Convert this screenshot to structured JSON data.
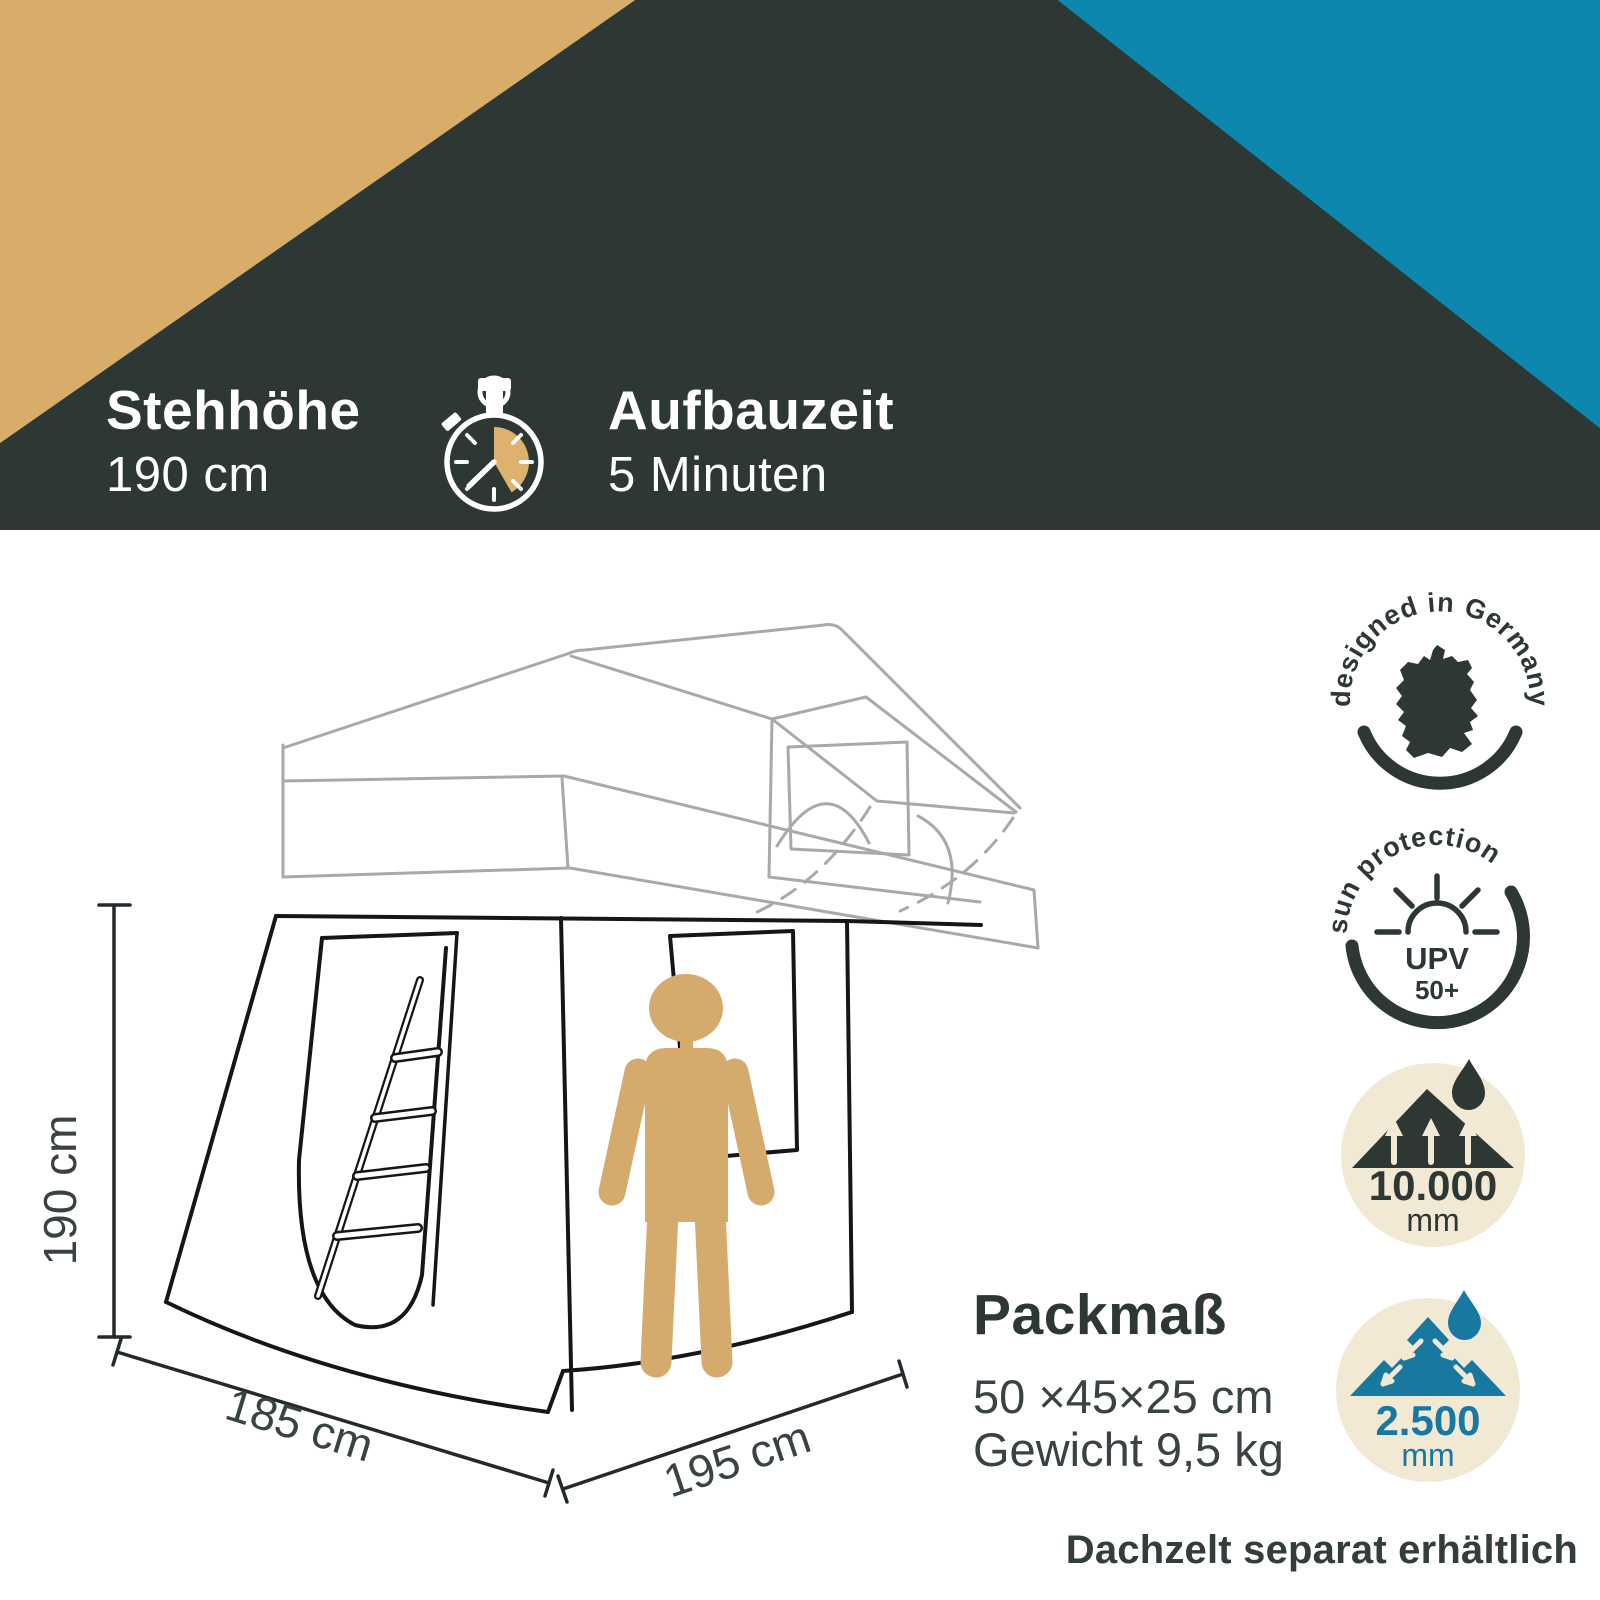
{
  "header": {
    "feature1_title": "Stehhöhe",
    "feature1_value": "190 cm",
    "feature2_title": "Aufbauzeit",
    "feature2_value": "5 Minuten"
  },
  "dimensions": {
    "height_label": "190 cm",
    "depth_label": "185 cm",
    "width_label": "195 cm"
  },
  "badges": {
    "designed": {
      "arc_text": "designed in Germany"
    },
    "sun": {
      "arc_text": "sun protection",
      "line1": "UPV",
      "line2": "50+"
    },
    "waterproof_top": {
      "value": "10.000",
      "unit": "mm"
    },
    "waterproof_bottom": {
      "value": "2.500",
      "unit": "mm"
    }
  },
  "pack": {
    "title": "Packmaß",
    "size": "50 ×45×25 cm",
    "weight": "Gewicht 9,5 kg"
  },
  "footer_note": "Dachzelt separat erhältlich",
  "colors": {
    "charcoal": "#2d3734",
    "gold": "#d8ad6a",
    "teal": "#0d87ae",
    "icon_teal": "#1878a0",
    "beige": "#f2e9d4",
    "person_tan": "#d4ab6d",
    "line_gray": "#a9a9a9",
    "line_black": "#161616"
  }
}
